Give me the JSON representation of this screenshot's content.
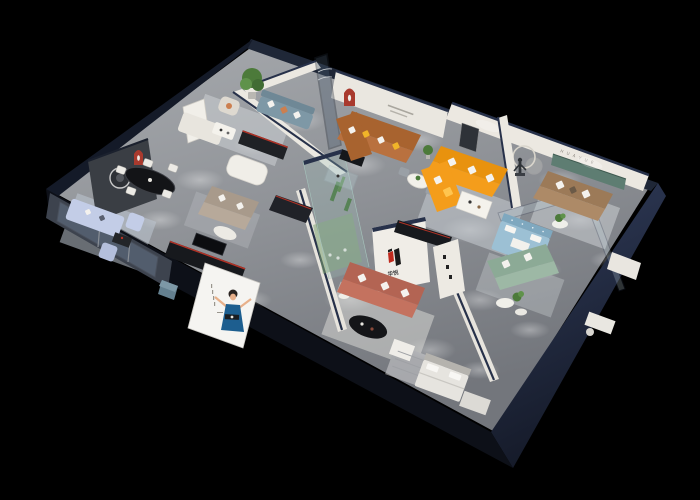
{
  "brand": {
    "logo_text": "华悦",
    "niche_letters": "H U A Y U E"
  },
  "colors": {
    "background": "#000000",
    "outer_wall": "#26304a",
    "outer_wall_dark": "#10141f",
    "floor": "#94979c",
    "interior_wall": "#ebe8e1",
    "accent_red": "#a93a2e",
    "logo_red": "#c02a1e",
    "sofa_orange": "#f49d1b",
    "sofa_brown": "#b9713f",
    "sofa_coral": "#c4725f",
    "sofa_tan": "#ad8a67",
    "sofa_green": "#9db8a5",
    "sofa_lavender": "#c3cde7",
    "sofa_bluegrey": "#7e98a6",
    "bed_blue": "#9cc0d4",
    "pillow_yellow": "#f0b429",
    "pillow_orange": "#cc7f4f",
    "plant_green": "#4c7a3a",
    "display_green": "#7ea372",
    "niche_green": "#5e7d72",
    "sculpture_terracotta": "#b05a40",
    "dress_blue": "#1d5e8f",
    "table_black": "#141518",
    "cube_teal": "#64808f"
  }
}
